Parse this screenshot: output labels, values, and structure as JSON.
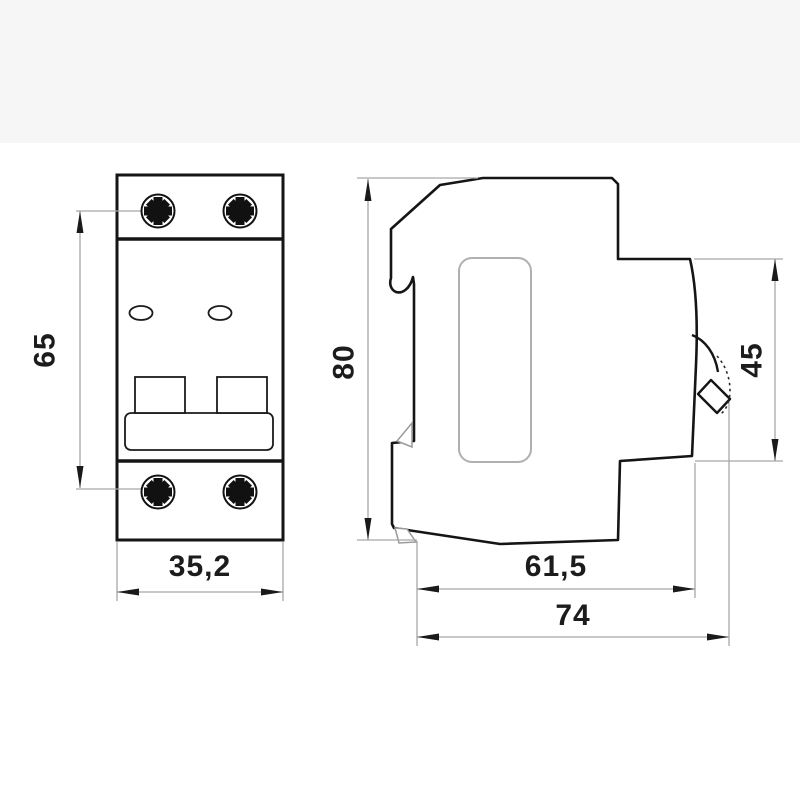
{
  "page": {
    "background": "#ffffff",
    "background_top_band": "#f6f6f6"
  },
  "drawing": {
    "type": "technical-dimension-drawing",
    "views": {
      "front": {
        "name": "front view"
      },
      "side": {
        "name": "side view"
      }
    },
    "dimensions": {
      "front_screw_spacing": {
        "label": "65",
        "value": 65
      },
      "front_width": {
        "label": "35,2",
        "value": 35.2
      },
      "side_height": {
        "label": "80",
        "value": 80
      },
      "side_lever_zone_height": {
        "label": "45",
        "value": 45
      },
      "side_depth_body": {
        "label": "61,5",
        "value": 61.5
      },
      "side_depth_total": {
        "label": "74",
        "value": 74
      }
    },
    "icons": [
      "screw-head-icon",
      "indicator-window-icon",
      "toggle-handle-icon",
      "lever-icon",
      "din-clip-icon"
    ],
    "colors": {
      "outline": "#151515",
      "thin_lines": "#a8a8a8",
      "light_detail": "#9a9a9a",
      "recess": "#b0b0b0",
      "text": "#1c1c1c"
    }
  }
}
